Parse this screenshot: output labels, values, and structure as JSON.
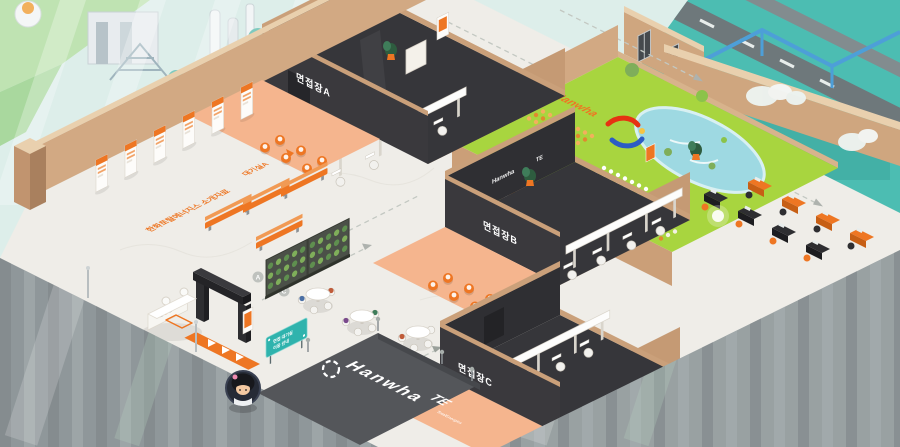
{
  "brand": {
    "hanwha": "Hanwha",
    "totalenergies": "TotalEnergies",
    "te_short": "TE"
  },
  "rooms": [
    {
      "id": "A",
      "label": "면접장A"
    },
    {
      "id": "B",
      "label": "면접장B"
    },
    {
      "id": "C",
      "label": "면접장C"
    }
  ],
  "floor_texts": {
    "intro_materials": "한화토탈에너지스 소개자료",
    "waiting_room_a": "대기실A",
    "waiting_room_c": "대기실C",
    "zone_letters": [
      "A",
      "B",
      "C"
    ]
  },
  "guide_sign": {
    "line1": "면접 대기실",
    "line2": "이동 안내"
  },
  "colors": {
    "accent_orange": "#EE7623",
    "hanwha_orange": "#F08300",
    "teal_sign": "#2FB3AD",
    "garden_green": "#A8D53F",
    "pond_blue": "#9ED9E2",
    "dark_room_floor": "#343437",
    "wall_tan": "#D2A983",
    "anteroom_salmon": "#F5B58E",
    "marble_floor": "#EFEDE8",
    "facade_gray": "#8F979A",
    "outdoor_teal": "#4CBDB2"
  }
}
